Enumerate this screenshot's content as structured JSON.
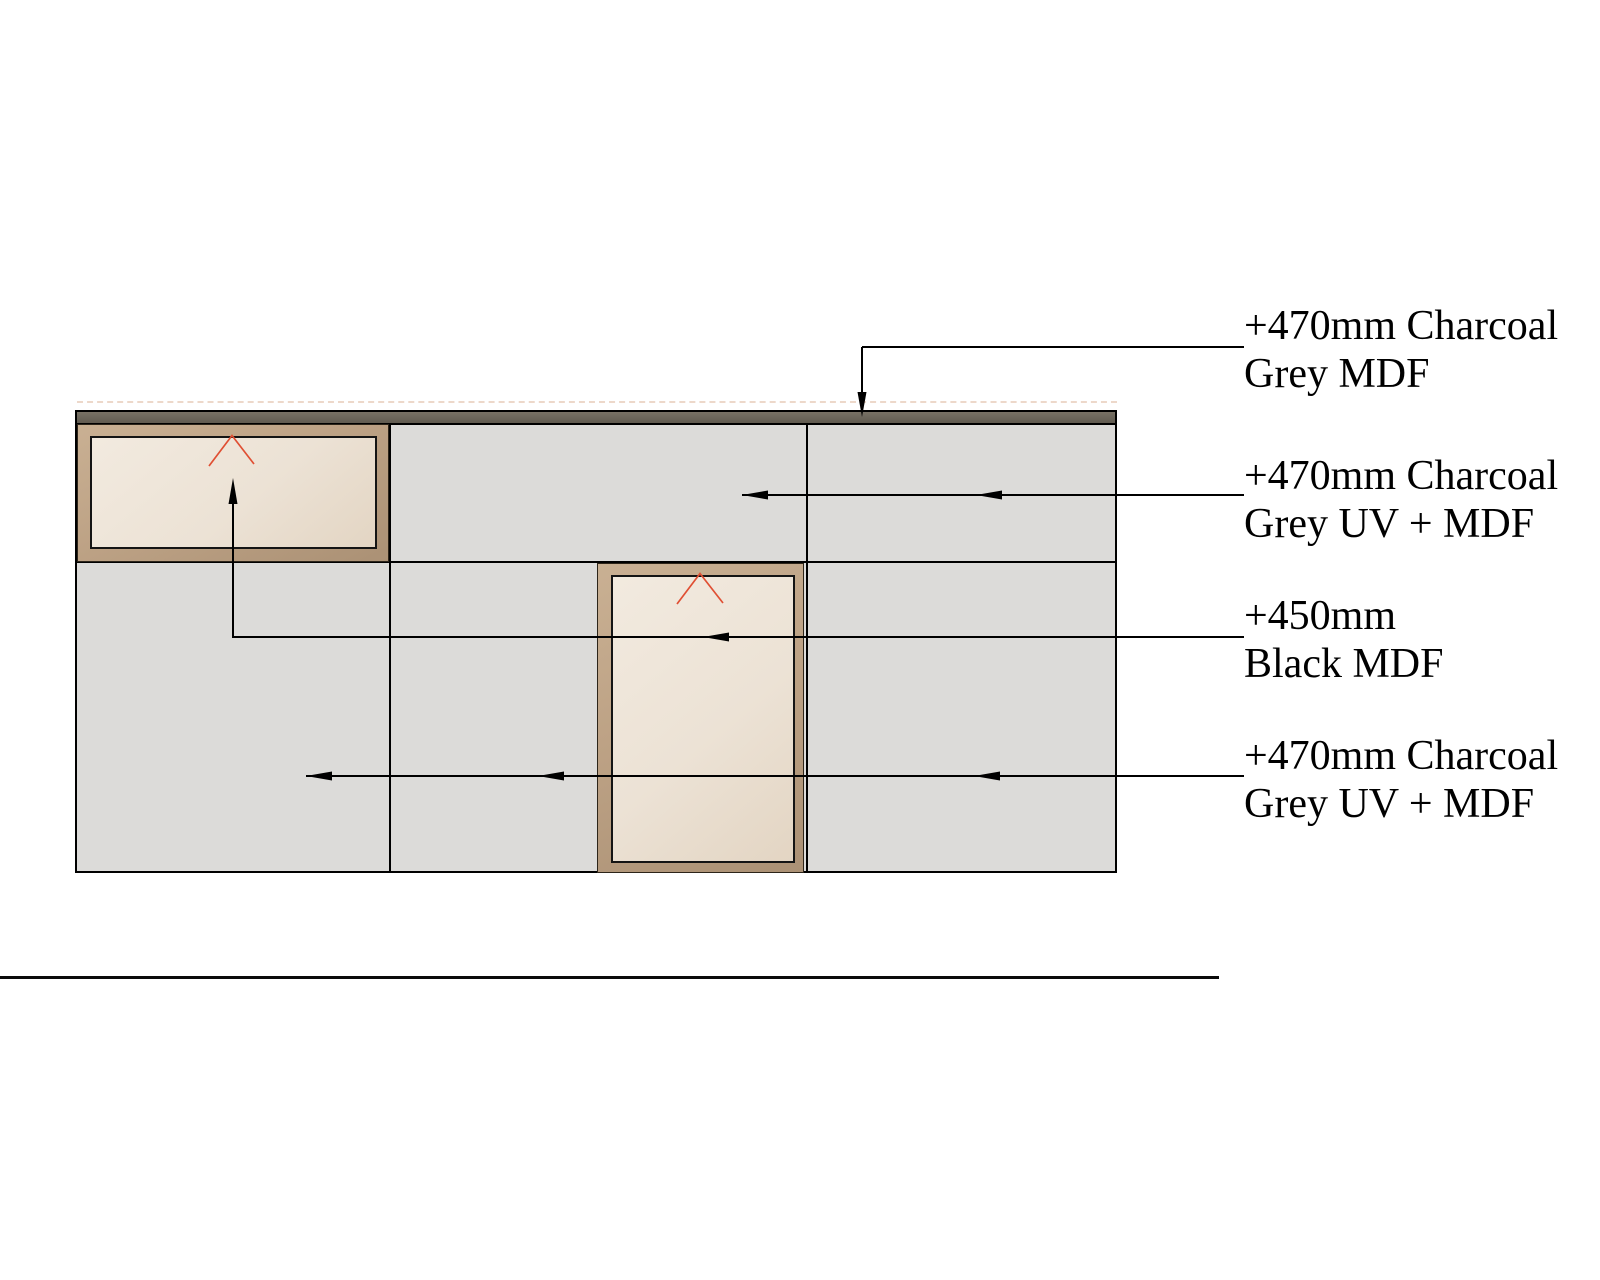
{
  "drawing": {
    "type": "joinery wall elevation",
    "annotations": [
      {
        "id": "top_strip",
        "line1": "+470mm Charcoal",
        "line2": "Grey MDF"
      },
      {
        "id": "row1_panels",
        "line1": "+470mm Charcoal",
        "line2": "Grey UV + MDF"
      },
      {
        "id": "black_mdf",
        "line1": "+450mm",
        "line2": "Black MDF"
      },
      {
        "id": "row2_panels",
        "line1": "+470mm Charcoal",
        "line2": "Grey UV + MDF"
      }
    ],
    "colors": {
      "panel_grey": "#dcdbd9",
      "strip_charcoal": "#6b655a",
      "frame_tan": "#bda285",
      "face_beige": "#ece2d5",
      "chevron_red": "#e04f33",
      "line_black": "#000000"
    }
  }
}
